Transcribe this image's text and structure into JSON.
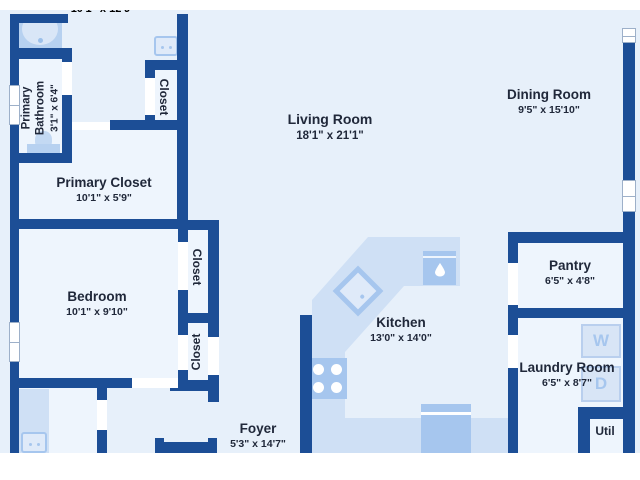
{
  "plan_title": "house floor plan",
  "colors": {
    "wall": "#1c4e96",
    "bg": "#e7f0fa",
    "room": "#eef5fd",
    "counter": "#cfe0f5",
    "appliance": "#a6c6ee",
    "text": "#20283a"
  },
  "rooms": [
    {
      "id": "cutoff-room-top",
      "name": "",
      "dims": "10'1\" x 12'9\""
    },
    {
      "id": "primary-bathroom",
      "name": "Primary Bathroom",
      "name_lines": [
        "Primary",
        "Bathroom"
      ],
      "dims": "3'1\" x 6'4\""
    },
    {
      "id": "closet-top-left",
      "name": "Closet",
      "dims": ""
    },
    {
      "id": "living-room",
      "name": "Living Room",
      "dims": "18'1\" x 21'1\""
    },
    {
      "id": "dining-room",
      "name": "Dining Room",
      "dims": "9'5\" x 15'10\""
    },
    {
      "id": "primary-closet",
      "name": "Primary Closet",
      "dims": "10'1\" x 5'9\""
    },
    {
      "id": "bedroom",
      "name": "Bedroom",
      "dims": "10'1\" x 9'10\""
    },
    {
      "id": "bedroom-closet-upper",
      "name": "Closet",
      "dims": ""
    },
    {
      "id": "bedroom-closet-lower",
      "name": "Closet",
      "dims": ""
    },
    {
      "id": "kitchen",
      "name": "Kitchen",
      "dims": "13'0\" x 14'0\""
    },
    {
      "id": "pantry",
      "name": "Pantry",
      "dims": "6'5\" x 4'8\""
    },
    {
      "id": "laundry-room",
      "name": "Laundry Room",
      "dims": "6'5\" x 8'7\""
    },
    {
      "id": "foyer",
      "name": "Foyer",
      "dims": "5'3\" x 14'7\""
    },
    {
      "id": "util",
      "name": "Util",
      "dims": ""
    }
  ],
  "appliances": {
    "washer": "W",
    "dryer": "D"
  }
}
